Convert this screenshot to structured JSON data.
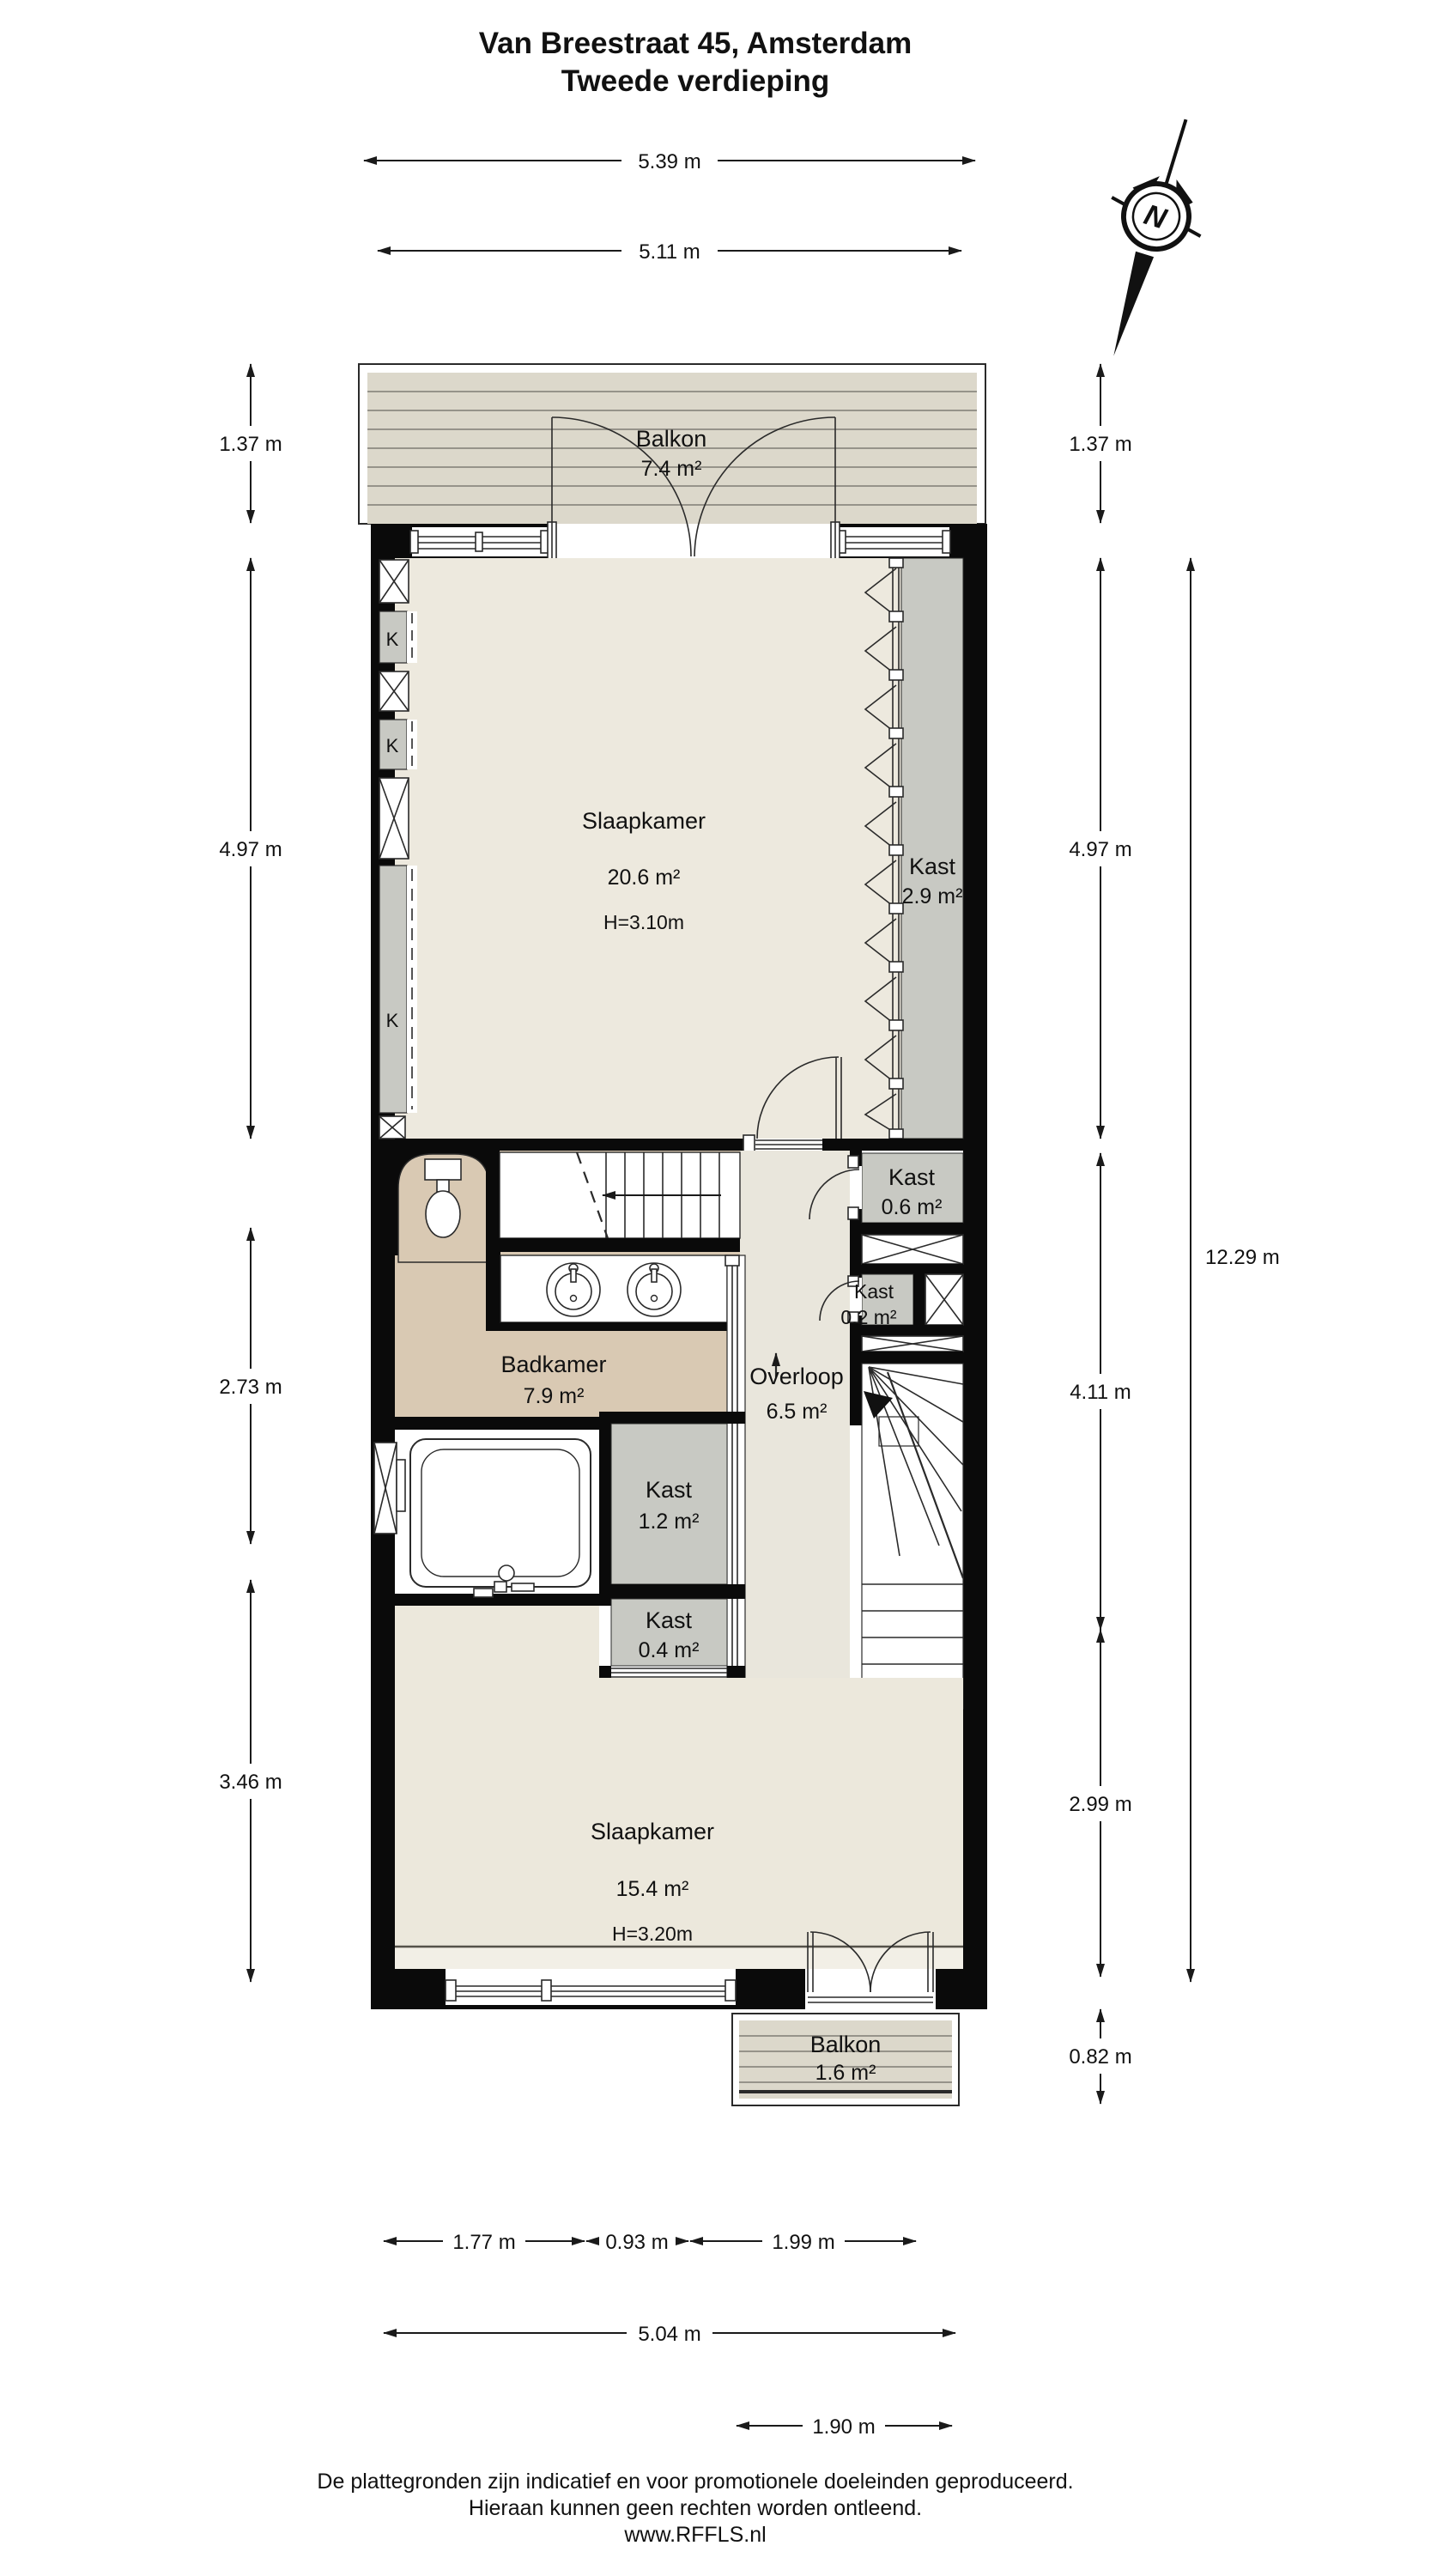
{
  "title": {
    "line1": "Van Breestraat 45, Amsterdam",
    "line2": "Tweede verdieping"
  },
  "compass": {
    "north_label": "N"
  },
  "rooms": {
    "balkon_top": {
      "name": "Balkon",
      "area": "7.4 m²"
    },
    "slaapkamer1": {
      "name": "Slaapkamer",
      "area": "20.6 m²",
      "ceiling": "H=3.10m"
    },
    "kast29": {
      "name": "Kast",
      "area": "2.9 m²"
    },
    "kast06": {
      "name": "Kast",
      "area": "0.6 m²"
    },
    "kast02": {
      "name": "Kast",
      "area": "0.2 m²"
    },
    "badkamer": {
      "name": "Badkamer",
      "area": "7.9 m²"
    },
    "overloop": {
      "name": "Overloop",
      "area": "6.5 m²"
    },
    "kast12": {
      "name": "Kast",
      "area": "1.2 m²"
    },
    "kast04": {
      "name": "Kast",
      "area": "0.4 m²"
    },
    "slaapkamer2": {
      "name": "Slaapkamer",
      "area": "15.4 m²",
      "ceiling": "H=3.20m"
    },
    "balkon_bottom": {
      "name": "Balkon",
      "area": "1.6 m²"
    },
    "closets": [
      "K",
      "K",
      "K"
    ]
  },
  "dims": {
    "top": [
      "5.39 m",
      "5.11 m"
    ],
    "left": [
      "1.37 m",
      "4.97 m",
      "2.73 m",
      "3.46 m"
    ],
    "right": [
      "1.37 m",
      "4.97 m",
      "4.11 m",
      "2.99 m",
      "0.82 m"
    ],
    "right_total": "12.29 m",
    "bottom": [
      "1.77 m",
      "0.93 m",
      "1.99 m"
    ],
    "bottom_total": "5.04 m",
    "balcony_width": "1.90 m"
  },
  "footer": {
    "line1": "De plattegronden zijn indicatief en voor promotionele doeleinden geproduceerd.",
    "line2": "Hieraan kunnen geen rechten worden ontleend.",
    "line3": "www.RFFLS.nl"
  }
}
